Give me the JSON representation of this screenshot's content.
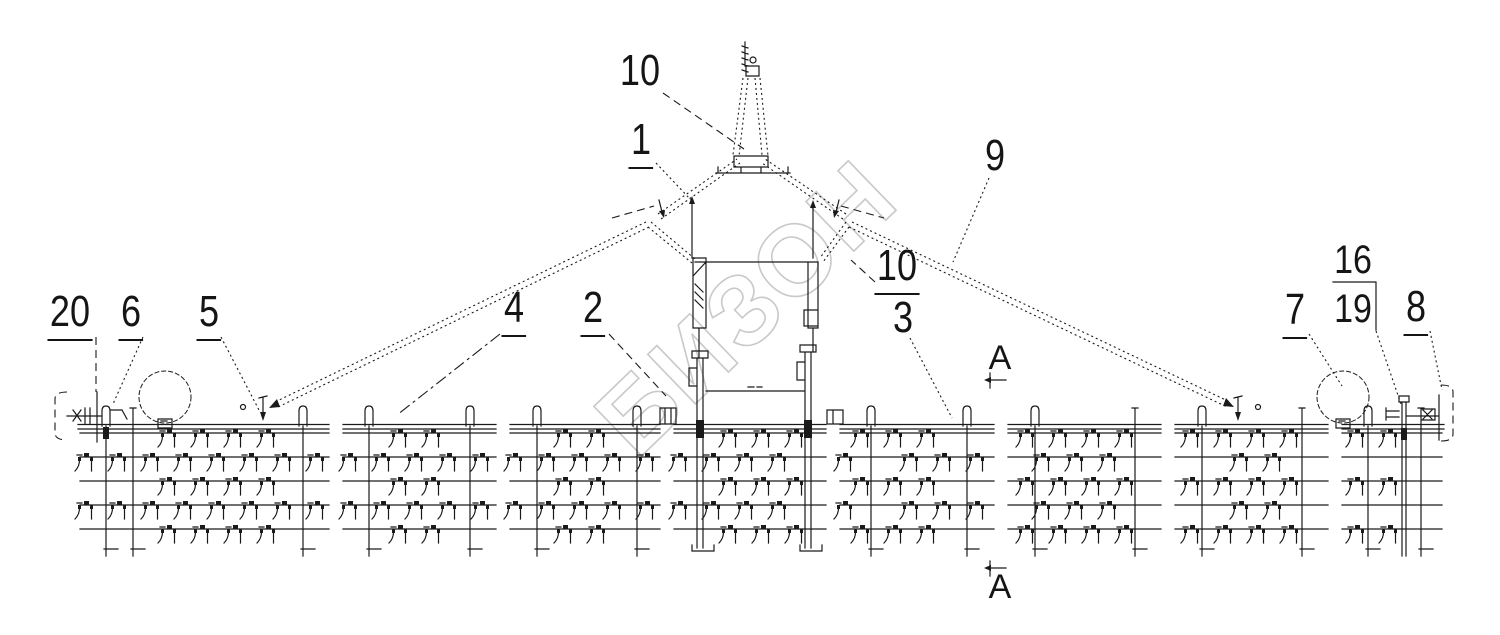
{
  "drawing": {
    "background": "#ffffff",
    "line_color": "#1a1a1a",
    "watermark": {
      "text": "БИЗОН",
      "color": "#c9c9c9",
      "x": 770,
      "y": 332,
      "angle": -44,
      "font_size": 100
    },
    "callouts": [
      {
        "label": "10",
        "x": 640,
        "y": 71,
        "underline": false,
        "leader": {
          "x1": 663,
          "y1": 93,
          "x2": 744,
          "y2": 149,
          "style": "dashed"
        }
      },
      {
        "label": "1",
        "x": 641,
        "y": 140,
        "underline": true,
        "leader": {
          "x1": 656,
          "y1": 163,
          "x2": 691,
          "y2": 200,
          "style": "dotted"
        }
      },
      {
        "label": "9",
        "x": 995,
        "y": 156,
        "underline": false,
        "leader": {
          "x1": 989,
          "y1": 178,
          "x2": 953,
          "y2": 262,
          "style": "dotted"
        }
      },
      {
        "label": "10",
        "x": 897,
        "y": 266,
        "underline": true,
        "leader": {
          "x1": 875,
          "y1": 282,
          "x2": 851,
          "y2": 260,
          "style": "dashed"
        }
      },
      {
        "label": "3",
        "x": 903,
        "y": 318,
        "underline": false,
        "leader": {
          "x1": 910,
          "y1": 338,
          "x2": 952,
          "y2": 418,
          "style": "dotted"
        }
      },
      {
        "label": "4",
        "x": 514,
        "y": 308,
        "underline": true,
        "leader": {
          "x1": 500,
          "y1": 334,
          "x2": 397,
          "y2": 415,
          "style": "dashdot"
        }
      },
      {
        "label": "2",
        "x": 593,
        "y": 308,
        "underline": true,
        "leader": {
          "x1": 609,
          "y1": 334,
          "x2": 666,
          "y2": 396,
          "style": "dashed"
        }
      },
      {
        "label": "20",
        "x": 70,
        "y": 312,
        "underline": true,
        "leader": {
          "x1": 96,
          "y1": 337,
          "x2": 96,
          "y2": 392,
          "style": "dashed"
        }
      },
      {
        "label": "6",
        "x": 131,
        "y": 312,
        "underline": true,
        "leader": {
          "x1": 143,
          "y1": 337,
          "x2": 113,
          "y2": 404,
          "style": "dotted"
        }
      },
      {
        "label": "5",
        "x": 209,
        "y": 312,
        "underline": true,
        "leader": {
          "x1": 221,
          "y1": 337,
          "x2": 259,
          "y2": 410,
          "style": "dotted"
        }
      },
      {
        "label": "7",
        "x": 1295,
        "y": 310,
        "underline": true,
        "leader": {
          "x1": 1309,
          "y1": 334,
          "x2": 1342,
          "y2": 386,
          "style": "dotted"
        }
      },
      {
        "label": "8",
        "x": 1416,
        "y": 307,
        "underline": true,
        "leader": {
          "x1": 1430,
          "y1": 331,
          "x2": 1442,
          "y2": 390,
          "style": "dotted"
        }
      }
    ],
    "fraction_callout": {
      "top": "16",
      "bottom": "19",
      "x": 1353,
      "y": 240,
      "bar": {
        "x1": 1333,
        "x2": 1376,
        "y": 282
      },
      "vline": {
        "x": 1376,
        "y1": 282,
        "y2": 330
      },
      "leader": {
        "x1": 1376,
        "y1": 331,
        "x2": 1401,
        "y2": 404,
        "style": "dotted"
      }
    },
    "section_marks": {
      "letter": "А",
      "top": {
        "lx": 1000,
        "ly": 358,
        "ax": 990,
        "ay": 380
      },
      "bottom": {
        "lx": 1000,
        "ly": 587,
        "ax": 990,
        "ay": 568
      }
    },
    "geometry": {
      "canvas": {
        "w": 1500,
        "h": 635
      },
      "toolbar": {
        "x1": 78,
        "x2": 1444,
        "y_top": 424.5,
        "y_bot": 429,
        "gap_centers": [
          336,
          503,
          667,
          833,
          1001,
          1168,
          1335
        ],
        "gap_half": 7
      },
      "rows": {
        "ys": [
          433,
          457,
          481,
          505,
          529
        ],
        "x1": 80,
        "x2": 1442,
        "tine_spacing": 33,
        "offsets": [
          23,
          6,
          23,
          6,
          23
        ]
      },
      "beams": [
        {
          "x": 106,
          "cap": true,
          "blob": true
        },
        {
          "x": 133,
          "cap": false
        },
        {
          "x": 303,
          "cap": true
        },
        {
          "x": 369,
          "cap": true
        },
        {
          "x": 470,
          "cap": true
        },
        {
          "x": 537,
          "cap": true
        },
        {
          "x": 637,
          "cap": true
        },
        {
          "x": 871,
          "cap": true
        },
        {
          "x": 967,
          "cap": true
        },
        {
          "x": 1035,
          "cap": true
        },
        {
          "x": 1135,
          "cap": false
        },
        {
          "x": 1202,
          "cap": true
        },
        {
          "x": 1302,
          "cap": false
        },
        {
          "x": 1368,
          "cap": true
        },
        {
          "x": 1421,
          "cap": false
        }
      ],
      "beam_bottom": 556,
      "standards": [
        {
          "x": 700,
          "top": 358
        },
        {
          "x": 808,
          "top": 352
        }
      ],
      "heavy_beam": {
        "x": 1404,
        "top": 402
      },
      "wheels": [
        {
          "cx": 165,
          "cy": 397,
          "r": 26
        },
        {
          "cx": 1343,
          "cy": 397,
          "r": 26
        }
      ],
      "pins": [
        {
          "x": 263,
          "circle_x": 243
        },
        {
          "x": 1238,
          "circle_x": 1258
        }
      ],
      "hitch": {
        "x": 745,
        "top": 42
      },
      "braces": {
        "left": [
          646,
          222,
          273,
          403
        ],
        "right": [
          852,
          222,
          1230,
          402
        ]
      }
    }
  }
}
